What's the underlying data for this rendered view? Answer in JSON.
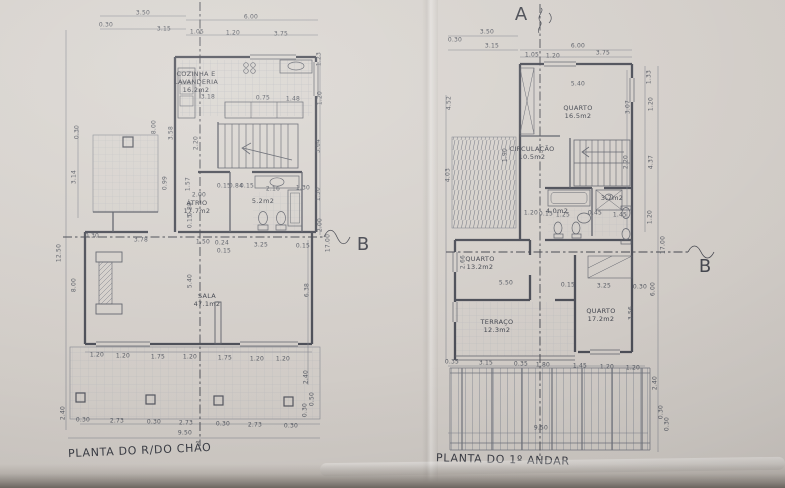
{
  "page": {
    "paper_color": "#d3cec9",
    "edge_color": "#6f6963",
    "line_color": "#4c4e57"
  },
  "plans": [
    {
      "title": "PLANTA DO R/DO CHÃO",
      "rooms": [
        {
          "t": "COZINHA E\nLAVANDERIA\n16.2m2",
          "x": 196,
          "y": 82
        },
        {
          "t": "ÁTRIO\n17.7m2",
          "x": 197,
          "y": 207
        },
        {
          "t": "5.2m2",
          "x": 263,
          "y": 201
        },
        {
          "t": "SALA\n47.1m2",
          "x": 207,
          "y": 300
        }
      ],
      "dims": [
        {
          "t": "3.50",
          "x": 143,
          "y": 13
        },
        {
          "t": "0.30",
          "x": 106,
          "y": 25
        },
        {
          "t": "3.15",
          "x": 164,
          "y": 29
        },
        {
          "t": "6.00",
          "x": 251,
          "y": 17
        },
        {
          "t": "1.05",
          "x": 197,
          "y": 32
        },
        {
          "t": "1.20",
          "x": 233,
          "y": 33
        },
        {
          "t": "3.75",
          "x": 281,
          "y": 34
        },
        {
          "t": "1.23",
          "x": 319,
          "y": 59,
          "r": -90
        },
        {
          "t": "1.20",
          "x": 320,
          "y": 98,
          "r": -90
        },
        {
          "t": "3.64",
          "x": 318,
          "y": 146,
          "r": -90
        },
        {
          "t": "1.50",
          "x": 318,
          "y": 194,
          "r": -90
        },
        {
          "t": "2.00",
          "x": 320,
          "y": 225,
          "r": -90
        },
        {
          "t": "17.00",
          "x": 328,
          "y": 243,
          "r": -90
        },
        {
          "t": "0.30",
          "x": 77,
          "y": 132,
          "r": -90
        },
        {
          "t": "3.14",
          "x": 74,
          "y": 177,
          "r": -90
        },
        {
          "t": "12.50",
          "x": 59,
          "y": 253,
          "r": -90
        },
        {
          "t": "8.00",
          "x": 74,
          "y": 285,
          "r": -90
        },
        {
          "t": "2.40",
          "x": 63,
          "y": 413,
          "r": -90
        },
        {
          "t": "8.00",
          "x": 154,
          "y": 127,
          "r": -90
        },
        {
          "t": "3.58",
          "x": 171,
          "y": 133,
          "r": -90
        },
        {
          "t": "2.20",
          "x": 196,
          "y": 143,
          "r": -90
        },
        {
          "t": "1.57",
          "x": 188,
          "y": 184,
          "r": -90
        },
        {
          "t": "0.88",
          "x": 190,
          "y": 209,
          "r": -90
        },
        {
          "t": "0.15",
          "x": 190,
          "y": 221,
          "r": -90
        },
        {
          "t": "0.99",
          "x": 165,
          "y": 183,
          "r": -90
        },
        {
          "t": "5.40",
          "x": 190,
          "y": 281,
          "r": -90
        },
        {
          "t": "6.38",
          "x": 307,
          "y": 290,
          "r": -90
        },
        {
          "t": "2.40",
          "x": 306,
          "y": 377,
          "r": -90
        },
        {
          "t": "0.50",
          "x": 312,
          "y": 399,
          "r": -90
        },
        {
          "t": "0.30",
          "x": 305,
          "y": 410,
          "r": -90
        },
        {
          "t": "3.18",
          "x": 208,
          "y": 97
        },
        {
          "t": "0.75",
          "x": 263,
          "y": 98
        },
        {
          "t": "1.48",
          "x": 293,
          "y": 99
        },
        {
          "t": "2.00",
          "x": 199,
          "y": 195
        },
        {
          "t": "0.15",
          "x": 224,
          "y": 186
        },
        {
          "t": "0.84",
          "x": 236,
          "y": 186
        },
        {
          "t": "0.15",
          "x": 247,
          "y": 186
        },
        {
          "t": "2.16",
          "x": 273,
          "y": 189
        },
        {
          "t": "1.30",
          "x": 303,
          "y": 188
        },
        {
          "t": "0.30",
          "x": 92,
          "y": 236
        },
        {
          "t": "3.78",
          "x": 141,
          "y": 240
        },
        {
          "t": "1.50",
          "x": 203,
          "y": 242
        },
        {
          "t": "0.24",
          "x": 222,
          "y": 243
        },
        {
          "t": "0.15",
          "x": 224,
          "y": 251
        },
        {
          "t": "3.25",
          "x": 261,
          "y": 245
        },
        {
          "t": "0.15",
          "x": 303,
          "y": 246
        },
        {
          "t": "1.20",
          "x": 97,
          "y": 355
        },
        {
          "t": "1.20",
          "x": 123,
          "y": 356
        },
        {
          "t": "1.75",
          "x": 158,
          "y": 357
        },
        {
          "t": "1.20",
          "x": 190,
          "y": 357
        },
        {
          "t": "1.75",
          "x": 225,
          "y": 358
        },
        {
          "t": "1.20",
          "x": 257,
          "y": 359
        },
        {
          "t": "1.20",
          "x": 283,
          "y": 359
        },
        {
          "t": "0.30",
          "x": 83,
          "y": 420
        },
        {
          "t": "2.73",
          "x": 117,
          "y": 421
        },
        {
          "t": "0.30",
          "x": 154,
          "y": 422
        },
        {
          "t": "2.73",
          "x": 186,
          "y": 423
        },
        {
          "t": "0.30",
          "x": 223,
          "y": 424
        },
        {
          "t": "2.73",
          "x": 255,
          "y": 425
        },
        {
          "t": "0.30",
          "x": 291,
          "y": 426
        },
        {
          "t": "9.50",
          "x": 185,
          "y": 433
        }
      ]
    },
    {
      "title": "PLANTA DO 1º ANDAR",
      "rooms": [
        {
          "t": "QUARTO\n16.5m2",
          "x": 578,
          "y": 112
        },
        {
          "t": "CIRCULAÇÃO\n10.5m2",
          "x": 532,
          "y": 153
        },
        {
          "t": "4.0m2",
          "x": 557,
          "y": 211
        },
        {
          "t": "3.7m2",
          "x": 612,
          "y": 198
        },
        {
          "t": "QUARTO\n13.2m2",
          "x": 480,
          "y": 263
        },
        {
          "t": "TERRAÇO\n12.3m2",
          "x": 497,
          "y": 326
        },
        {
          "t": "QUARTO\n17.2m2",
          "x": 601,
          "y": 315
        }
      ],
      "dims": [
        {
          "t": "3.50",
          "x": 487,
          "y": 32
        },
        {
          "t": "0.30",
          "x": 455,
          "y": 40
        },
        {
          "t": "3.15",
          "x": 492,
          "y": 46
        },
        {
          "t": "6.00",
          "x": 578,
          "y": 46
        },
        {
          "t": "1.05",
          "x": 532,
          "y": 55
        },
        {
          "t": "1.20",
          "x": 553,
          "y": 56
        },
        {
          "t": "3.75",
          "x": 603,
          "y": 53
        },
        {
          "t": "5.40",
          "x": 578,
          "y": 84
        },
        {
          "t": "1.33",
          "x": 649,
          "y": 77,
          "r": -90
        },
        {
          "t": "1.20",
          "x": 651,
          "y": 104,
          "r": -90
        },
        {
          "t": "3.07",
          "x": 628,
          "y": 107,
          "r": -90
        },
        {
          "t": "4.37",
          "x": 651,
          "y": 162,
          "r": -90
        },
        {
          "t": "2.20",
          "x": 626,
          "y": 162,
          "r": -90
        },
        {
          "t": "1.20",
          "x": 650,
          "y": 217,
          "r": -90
        },
        {
          "t": "17.00",
          "x": 663,
          "y": 245,
          "r": -90
        },
        {
          "t": "6.00",
          "x": 653,
          "y": 289,
          "r": -90
        },
        {
          "t": "3.56",
          "x": 631,
          "y": 313,
          "r": -90
        },
        {
          "t": "2.40",
          "x": 655,
          "y": 383,
          "r": -90
        },
        {
          "t": "0.30",
          "x": 661,
          "y": 412,
          "r": -90
        },
        {
          "t": "0.30",
          "x": 667,
          "y": 424,
          "r": -90
        },
        {
          "t": "4.52",
          "x": 449,
          "y": 103,
          "r": -90
        },
        {
          "t": "1.90",
          "x": 505,
          "y": 155,
          "r": -90
        },
        {
          "t": "4.03",
          "x": 448,
          "y": 175,
          "r": -90
        },
        {
          "t": "2.66",
          "x": 463,
          "y": 262,
          "r": -90
        },
        {
          "t": "5.50",
          "x": 506,
          "y": 283
        },
        {
          "t": "0.15",
          "x": 568,
          "y": 285
        },
        {
          "t": "3.25",
          "x": 604,
          "y": 286
        },
        {
          "t": "0.30",
          "x": 640,
          "y": 287
        },
        {
          "t": "1.20",
          "x": 531,
          "y": 213
        },
        {
          "t": "0.15",
          "x": 546,
          "y": 214
        },
        {
          "t": "1.25",
          "x": 563,
          "y": 215
        },
        {
          "t": "0.45",
          "x": 595,
          "y": 213
        },
        {
          "t": "1.45",
          "x": 620,
          "y": 215
        },
        {
          "t": "0.35",
          "x": 452,
          "y": 362
        },
        {
          "t": "3.15",
          "x": 486,
          "y": 363
        },
        {
          "t": "0.35",
          "x": 521,
          "y": 364
        },
        {
          "t": "1.80",
          "x": 543,
          "y": 365
        },
        {
          "t": "1.45",
          "x": 580,
          "y": 366
        },
        {
          "t": "1.20",
          "x": 607,
          "y": 367
        },
        {
          "t": "1.20",
          "x": 633,
          "y": 368
        },
        {
          "t": "9.50",
          "x": 541,
          "y": 428
        }
      ]
    }
  ],
  "markers": [
    {
      "t": "A",
      "x": 521,
      "y": 15
    },
    {
      "t": "B",
      "x": 363,
      "y": 245
    },
    {
      "t": "B",
      "x": 705,
      "y": 267
    }
  ]
}
